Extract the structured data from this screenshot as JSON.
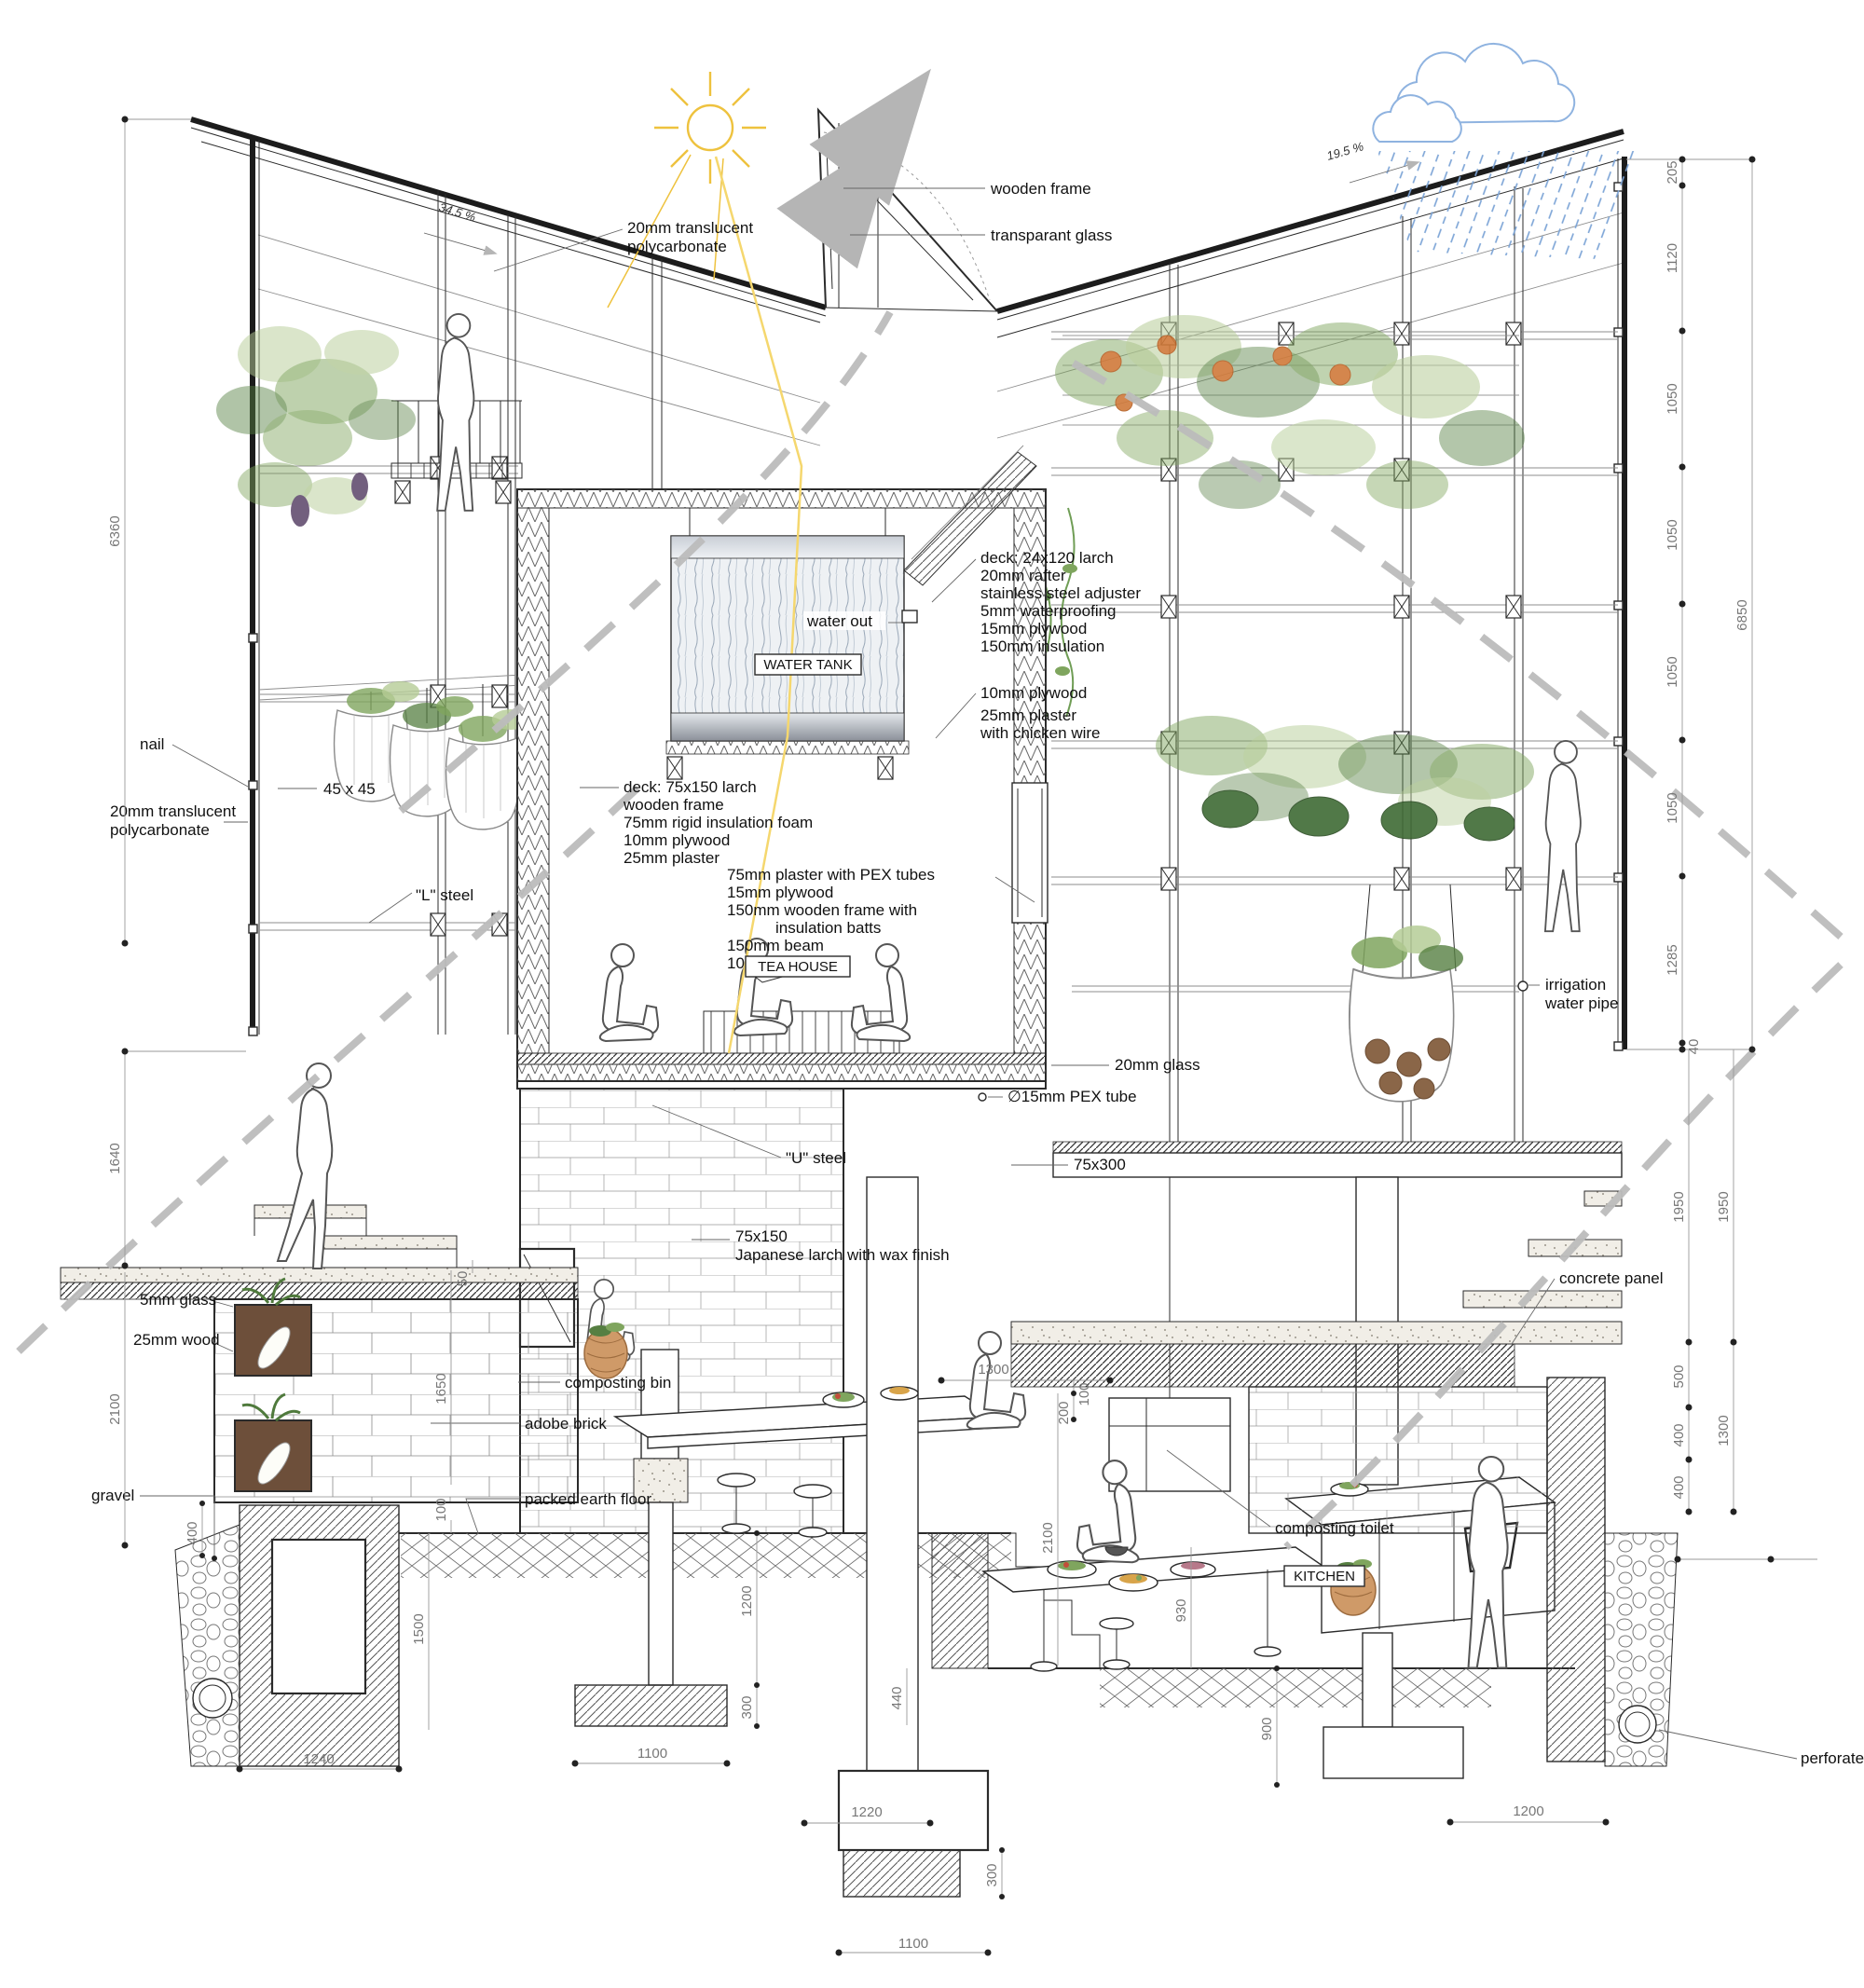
{
  "icons": {
    "sun": "sun-icon",
    "rain_cloud": "rain-cloud-icon",
    "airflow": "airflow-arrow-icon"
  },
  "slopes": {
    "left": "34.5 %",
    "right": "19.5 %"
  },
  "labels": {
    "wooden_frame": "wooden frame",
    "transparent_glass": "transparant glass",
    "roof_polycarbonate": [
      "20mm translucent",
      "polycarbonate"
    ],
    "nail": "nail",
    "batten": "45 x 45",
    "wall_polycarbonate": [
      "20mm translucent",
      "polycarbonate"
    ],
    "l_steel": "\"L\" steel",
    "water_out": "water out",
    "glass_20": "20mm glass",
    "pex_tube": "∅15mm PEX tube",
    "u_steel": "\"U\" steel",
    "beam_75x300": "75x300",
    "larch_post": [
      "75x150",
      "Japanese larch with wax finish"
    ],
    "irrigation": [
      "irrigation",
      "water pipe"
    ],
    "concrete_panel": "concrete panel",
    "composting_bin": "composting bin",
    "adobe_brick": "adobe brick",
    "packed_earth": "packed earth floor",
    "glass_5": "5mm glass",
    "wood_25": "25mm wood",
    "gravel": "gravel",
    "composting_toilet": "composting toilet",
    "perforated_pipe": "perforated pipe"
  },
  "specs": {
    "roof_deck": [
      "deck: 24x120 larch",
      "20mm rafter",
      "stainless steel adjuster",
      "5mm waterproofing",
      "15mm plywood",
      "150mm insulation"
    ],
    "wall_plaster": [
      "10mm plywood",
      "25mm plaster",
      "with chicken wire"
    ],
    "tea_deck": [
      "deck: 75x150 larch",
      "wooden frame",
      "75mm  rigid insulation foam",
      "10mm  plywood",
      "25mm     plaster"
    ],
    "heated_floor": [
      "75mm plaster with PEX tubes",
      "15mm plywood",
      "150mm wooden frame with",
      "insulation batts",
      "150mm beam",
      "10mm plywood"
    ]
  },
  "rooms": {
    "water_tank": "WATER  TANK",
    "tea_house": "TEA HOUSE",
    "kitchen": "KITCHEN"
  },
  "dims": {
    "left": [
      "6360",
      "1640",
      "2100"
    ],
    "right_chain": [
      "205",
      "1120",
      "1050",
      "1050",
      "1050",
      "1050",
      "1285",
      "40"
    ],
    "right_total": "6850",
    "right_lower": [
      "1950",
      "1950",
      "500",
      "400",
      "400",
      "1300"
    ],
    "bottom_right": [
      "1200"
    ],
    "left_foot": [
      "400",
      "1240",
      "1500",
      "1650",
      "100",
      "50"
    ],
    "bar_foot": [
      "1200",
      "300",
      "1100"
    ],
    "center": [
      "1300",
      "100",
      "200",
      "2100",
      "930",
      "1220",
      "440"
    ],
    "pit_foot": [
      "900",
      "300",
      "1100"
    ]
  },
  "colors": {
    "line": "#2b2b2b",
    "dim_text": "#777777",
    "leaf": "#7fa55e",
    "leaf_light": "#b5cc96",
    "leaf_dark": "#567f42",
    "sun": "#eec23e",
    "rain": "#7ba3d6",
    "arrow": "#b9b9b9",
    "soil": "#6d4f3a",
    "fruit": "#d07a3a",
    "melon": "#3f6b35",
    "potato": "#8a6648"
  }
}
